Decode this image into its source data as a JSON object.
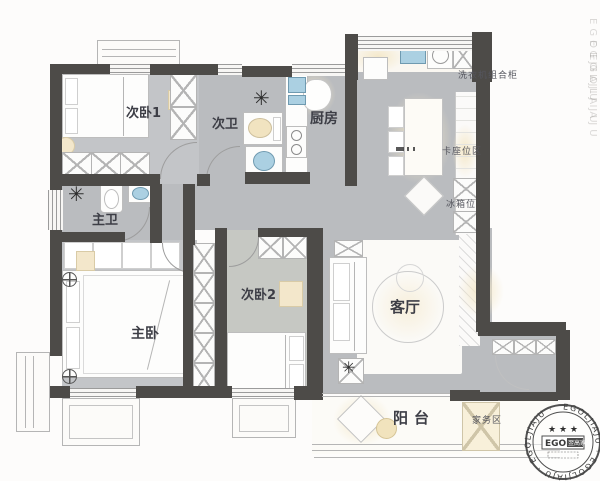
{
  "title": "apartment-floor-plan",
  "labels": {
    "bedroom1": "次卧1",
    "bath2": "次卫",
    "kitchen": "厨房",
    "bath1": "主卫",
    "master": "主卧",
    "bedroom2": "次卧2",
    "living": "客厅",
    "balcony": "阳台",
    "washer_cabinet": "洗衣机组合柜",
    "booth_seat": "卡座位区",
    "fridge": "冰箱位",
    "housework": "家务区"
  },
  "stamp": {
    "rim_text": "EGOLJIAJU · EGOLJIAJU · EGOLJIAJU ·",
    "stars": "★ ★ ★",
    "brand": "EGOL",
    "brand_cn": "翌高家居"
  },
  "watermark": {
    "text": "EGOLJIAJU"
  },
  "colors": {
    "wall": "#4d4b48",
    "floor": "#babcbf",
    "accent_cream": "#f3e7cb",
    "fixture_blue": "#abd0e2",
    "label_text": "#3d3e46"
  }
}
